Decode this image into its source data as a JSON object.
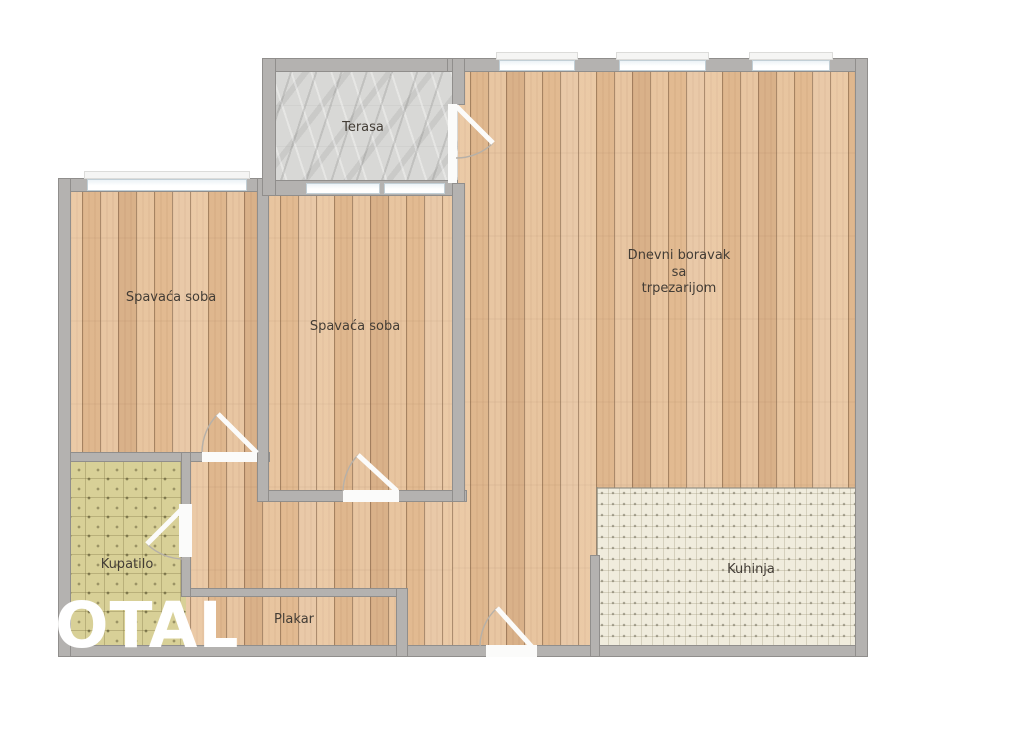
{
  "plan": {
    "type": "apartment-floor-plan",
    "watermark": "OTAL",
    "rooms": [
      {
        "id": "terasa",
        "label": "Terasa",
        "floor": "stone"
      },
      {
        "id": "spavaca-soba-left",
        "label": "Spavaća soba",
        "floor": "wood"
      },
      {
        "id": "spavaca-soba-middle",
        "label": "Spavaća soba",
        "floor": "wood"
      },
      {
        "id": "dnevni-boravak",
        "label": "Dnevni boravak sa trpezarijom",
        "label_lines": [
          "Dnevni boravak",
          "sa",
          "trpezarijom"
        ],
        "floor": "wood"
      },
      {
        "id": "kupatilo",
        "label": "Kupatilo",
        "floor": "bath-tile"
      },
      {
        "id": "plakar",
        "label": "Plakar",
        "floor": "wood"
      },
      {
        "id": "kuhinja",
        "label": "Kuhinja",
        "floor": "kitchen-tile"
      }
    ],
    "colors": {
      "wall": "#b4b2b0",
      "wall_border": "#908e8c",
      "wood_floor": "#e5bf97",
      "stone_floor": "#d8d8d6",
      "bath_tile": "#d8d097",
      "kitchen_tile": "#f0ecdd",
      "window": "#ffffff",
      "window_line": "#c2cfd6",
      "door_leaf": "#fbfbfa",
      "label_text": "#433d36",
      "watermark_text": "#ffffff"
    }
  }
}
